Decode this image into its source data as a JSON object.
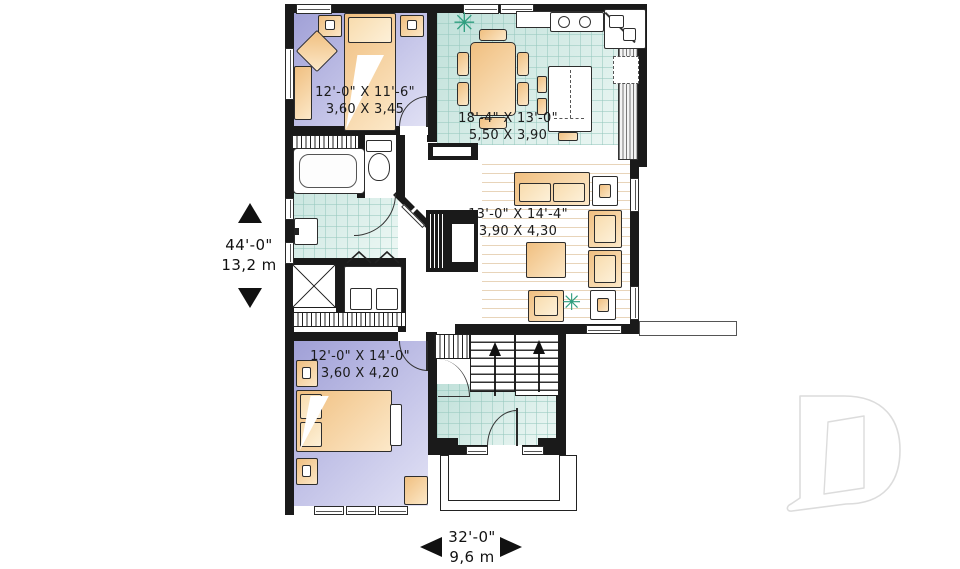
{
  "plan": {
    "rooms": {
      "bedroom1": {
        "imperial": "12'-0\" X 11'-6\"",
        "metric": "3,60 X 3,45"
      },
      "kitchen_dining": {
        "imperial": "18'-4\" X 13'-0\"",
        "metric": "5,50 X 3,90"
      },
      "living_room": {
        "imperial": "13'-0\" X 14'-4\"",
        "metric": "3,90 X 4,30"
      },
      "bedroom2": {
        "imperial": "12'-0\" X 14'-0\"",
        "metric": "3,60 X 4,20"
      }
    },
    "overall_depth": {
      "imperial": "44'-0\"",
      "metric": "13,2 m"
    },
    "overall_width": {
      "imperial": "32'-0\"",
      "metric": "9,6 m"
    }
  },
  "colors": {
    "wall": "#1a1a1a",
    "bedroom_a": "#9f9fd6",
    "bedroom_b": "#e2e2f5",
    "tile_a": "#bfe0d9",
    "tile_b": "#eef8f5",
    "tile_line": "rgba(150,200,190,0.55)",
    "furn_a": "#f0bf80",
    "furn_b": "#fce8c8",
    "plant": "#2f9e7f",
    "logo_outline": "#dcdcdc"
  },
  "logo": {
    "letter": "D"
  }
}
